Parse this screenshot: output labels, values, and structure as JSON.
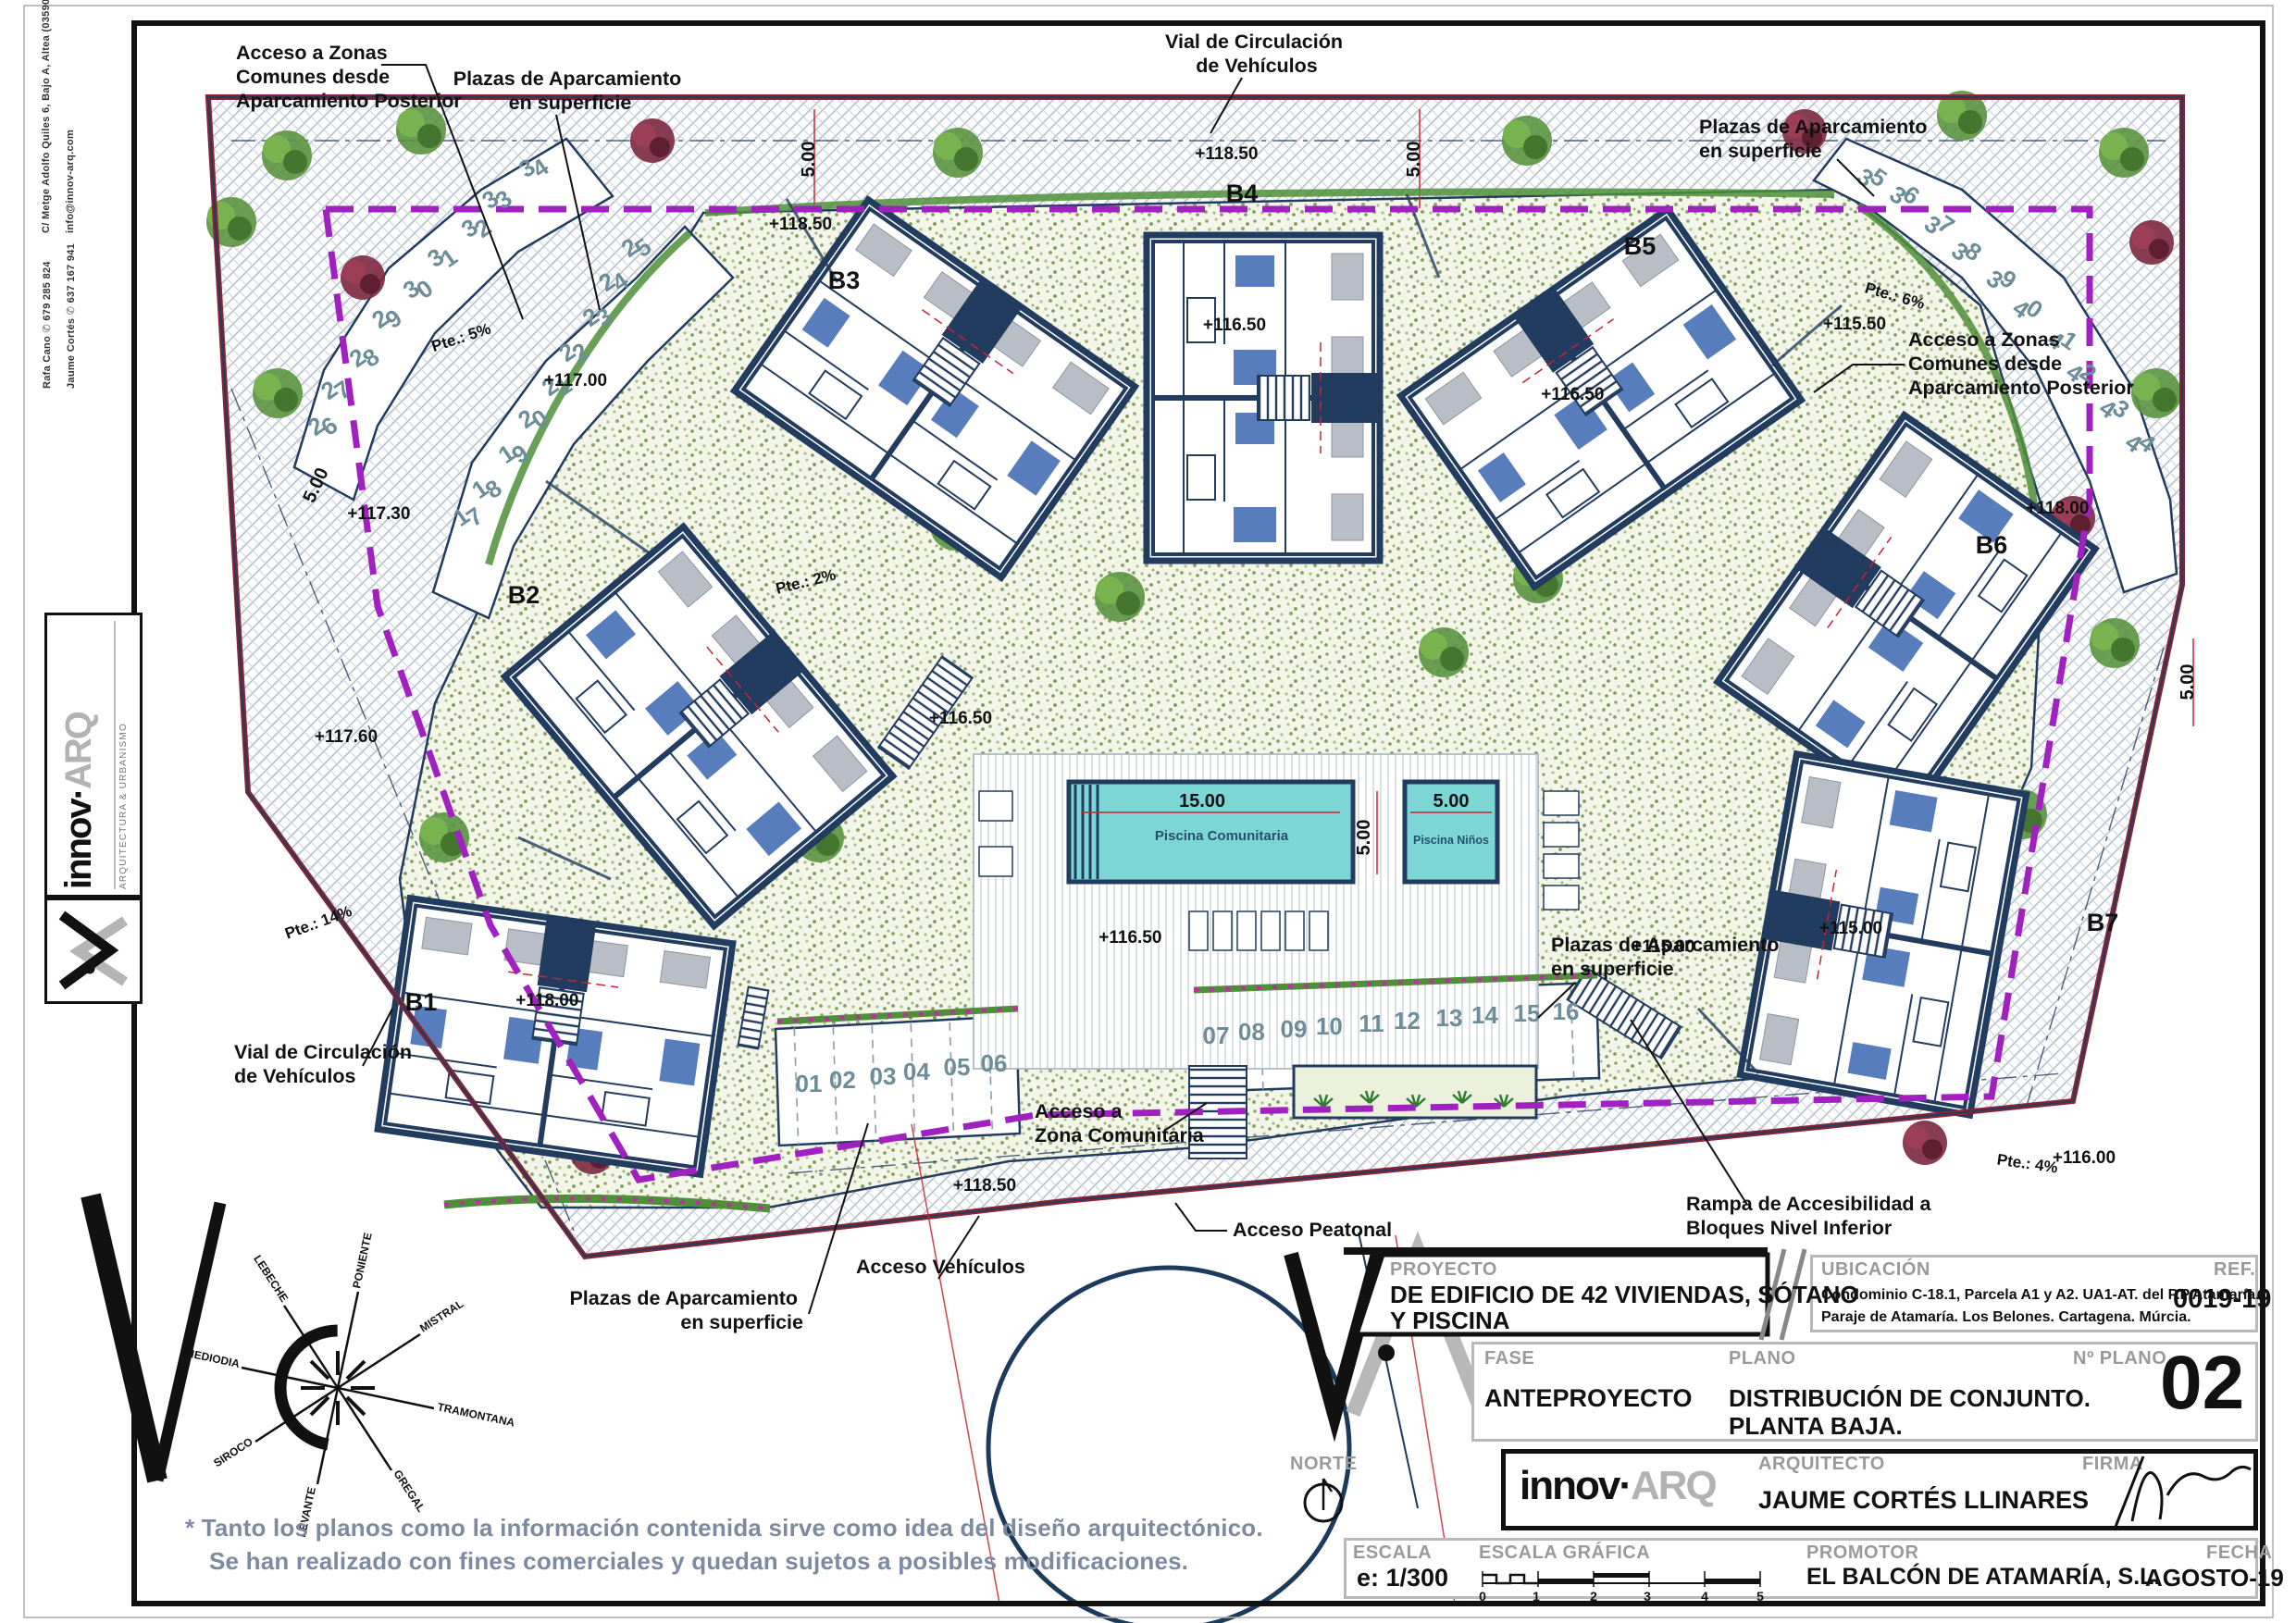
{
  "colors": {
    "boundary": "#8c2333",
    "setback_purple": "#a020c0",
    "wall_navy": "#223c5f",
    "pool_fill": "#7cd6d6",
    "green_dark": "#4f8f3a",
    "stall_number": "#6d8e99",
    "label_gray": "#9a9a9a",
    "disclaimer_blue": "#7d8aa0"
  },
  "margin": {
    "address": "C/ Metge Adolfo Quiles 6, Bajo A, Altea (03590)",
    "email": "info@innov-arq.com",
    "contact1_name": "Rafa Cano",
    "contact1_phone": "679 285 824",
    "contact2_name": "Jaume Cortés",
    "contact2_phone": "637 167 941",
    "logo_innov": "innov",
    "logo_dot": "·",
    "logo_arq": "ARQ",
    "logo_sub": "ARQUITECTURA & URBANISMO"
  },
  "plan": {
    "buildings": [
      "B1",
      "B2",
      "B3",
      "B4",
      "B5",
      "B6",
      "B7"
    ],
    "stalls": [
      "01",
      "02",
      "03",
      "04",
      "05",
      "06",
      "07",
      "08",
      "09",
      "10",
      "11",
      "12",
      "13",
      "14",
      "15",
      "16",
      "17",
      "18",
      "19",
      "20",
      "21",
      "22",
      "23",
      "24",
      "25",
      "26",
      "27",
      "28",
      "29",
      "30",
      "31",
      "32",
      "33",
      "34",
      "35",
      "36",
      "37",
      "38",
      "39",
      "40",
      "41",
      "42",
      "43",
      "44"
    ],
    "levels": [
      "+118.50",
      "+118.50",
      "+117.00",
      "+117.30",
      "+117.60",
      "+118.00",
      "+116.50",
      "+116.50",
      "+116.50",
      "+116.50",
      "+115.50",
      "+115.00",
      "+115.00",
      "+118.00",
      "+116.00",
      "+118.50"
    ],
    "slopes": [
      "Pte.: 5%",
      "Pte.: 2%",
      "Pte.: 6%",
      "Pte.: 14%",
      "Pte.: 4%"
    ],
    "dims": {
      "five": "5.00",
      "fifteen": "15.00"
    },
    "pool": {
      "main": "Piscina Comunitaria",
      "kids": "Piscina Niños"
    },
    "annotations": {
      "acc_zonas_tl": [
        "Acceso a Zonas",
        "Comunes desde",
        "Aparcamiento Posterior"
      ],
      "plazas_tl": [
        "Plazas de Aparcamiento",
        "en superficie"
      ],
      "vial_top": [
        "Vial de Circulación",
        "de Vehículos"
      ],
      "plazas_tr": [
        "Plazas de Aparcamiento",
        "en superficie"
      ],
      "acc_zonas_r": [
        "Acceso a Zonas",
        "Comunes desde",
        "Aparcamiento Posterior"
      ],
      "vial_left": [
        "Vial de Circulación",
        "de Vehículos"
      ],
      "plazas_b": [
        "Plazas de Aparcamiento",
        "en superficie"
      ],
      "acc_veh": "Acceso Vehículos",
      "acc_pea": "Acceso Peatonal",
      "acc_zc": [
        "Acceso a",
        "Zona Comunitaria"
      ],
      "rampa": [
        "Rampa de Accesibilidad a",
        "Bloques Nivel Inferior"
      ],
      "plazas_r": [
        "Plazas de Aparcamiento",
        "en superficie"
      ]
    },
    "compass": [
      "TRAMONTANA",
      "GREGAL",
      "LEVANTE",
      "SIROCO",
      "MEDIODIA",
      "LEBECHE",
      "PONIENTE",
      "MISTRAL"
    ]
  },
  "titleblock": {
    "proyecto_label": "PROYECTO",
    "proyecto_line1": "DE EDIFICIO DE 42 VIVIENDAS, SÓTANO",
    "proyecto_line2": "Y PISCINA",
    "ubicacion_label": "UBICACIÓN",
    "ubicacion_line1": "Condominio C-18.1, Parcela A1 y A2. UA1-AT. del P.P.Atamaría.",
    "ubicacion_line2": "Paraje de Atamaría. Los Belones. Cartagena. Múrcia.",
    "ref_label": "REF.",
    "ref_value": "0019-19",
    "fase_label": "FASE",
    "fase_value": "ANTEPROYECTO",
    "plano_label": "PLANO",
    "plano_line1": "DISTRIBUCIÓN DE CONJUNTO.",
    "plano_line2": "PLANTA BAJA.",
    "nplano_label": "Nº PLANO",
    "nplano_value": "02",
    "norte_label": "NORTE",
    "logo_innov": "innov",
    "logo_dot": "·",
    "logo_arq": "ARQ",
    "arquitecto_label": "ARQUITECTO",
    "arquitecto_value": "JAUME CORTÉS LLINARES",
    "firma_label": "FIRMA",
    "escala_label": "ESCALA",
    "escala_value": "e: 1/300",
    "escala_grafica_label": "ESCALA GRÁFICA",
    "scale_ticks": [
      "0",
      "1",
      "2",
      "3",
      "4",
      "5"
    ],
    "promotor_label": "PROMOTOR",
    "promotor_value": "EL BALCÓN DE ATAMARÍA, S.L.",
    "fecha_label": "FECHA",
    "fecha_value": "AGOSTO-19"
  },
  "disclaimer": {
    "line1": "* Tanto los planos como la información contenida sirve como idea del diseño arquitectónico.",
    "line2": "Se han realizado con fines comerciales y quedan sujetos a posibles modificaciones."
  }
}
